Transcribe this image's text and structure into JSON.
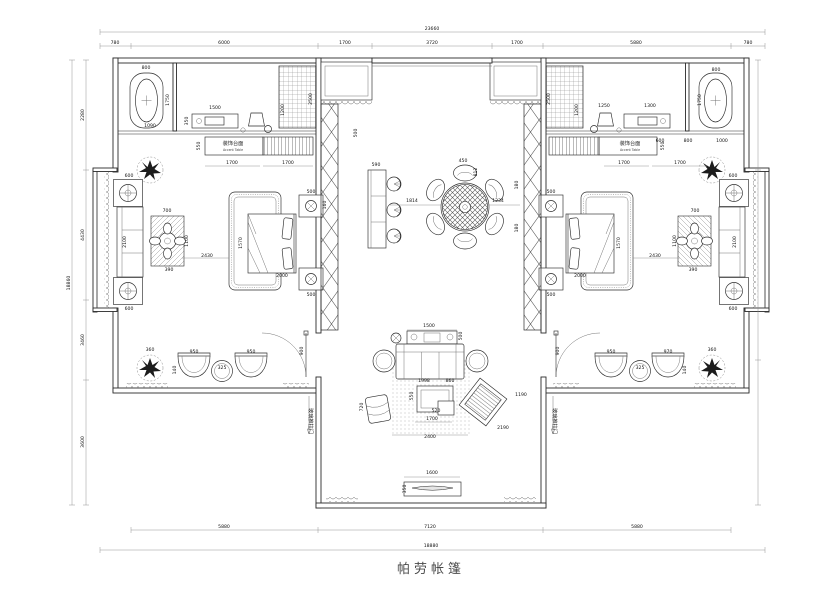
{
  "meta": {
    "drawing_type": "residential floor plan (CAD)",
    "bg_color": "#ffffff",
    "line_color": "#2b2b2b"
  },
  "title": "帕劳帐篷",
  "labels": {
    "accent_table_cn": "装饰台面",
    "accent_table_en": "Accent Table",
    "sliding_door": "玻璃推拉门"
  },
  "dimensions": {
    "top": {
      "overall": "23660",
      "segments": [
        "780",
        "6000",
        "1700",
        "3720",
        "1700",
        "5880",
        "780"
      ]
    },
    "bottom": {
      "overall": "18880",
      "segments": [
        "5880",
        "7120",
        "5880"
      ]
    },
    "left": {
      "overall": "18860",
      "segments": [
        "2280",
        "4430",
        "3460",
        "3600"
      ]
    }
  },
  "annotations": [
    {
      "t": "23660",
      "x": 432,
      "y": 30
    },
    {
      "t": "780",
      "x": 115,
      "y": 44
    },
    {
      "t": "6000",
      "x": 224,
      "y": 44
    },
    {
      "t": "1700",
      "x": 345,
      "y": 44
    },
    {
      "t": "3720",
      "x": 432,
      "y": 44
    },
    {
      "t": "1700",
      "x": 517,
      "y": 44
    },
    {
      "t": "5880",
      "x": 636,
      "y": 44
    },
    {
      "t": "780",
      "x": 748,
      "y": 44
    },
    {
      "t": "5880",
      "x": 224,
      "y": 528
    },
    {
      "t": "7120",
      "x": 430,
      "y": 528
    },
    {
      "t": "5880",
      "x": 637,
      "y": 528
    },
    {
      "t": "18880",
      "x": 431,
      "y": 547
    },
    {
      "t": "18860",
      "x": 70,
      "y": 283,
      "r": -90
    },
    {
      "t": "2280",
      "x": 84,
      "y": 115,
      "r": -90
    },
    {
      "t": "4430",
      "x": 84,
      "y": 235,
      "r": -90
    },
    {
      "t": "3460",
      "x": 84,
      "y": 340,
      "r": -90
    },
    {
      "t": "3600",
      "x": 84,
      "y": 442,
      "r": -90
    },
    {
      "t": "800",
      "x": 146,
      "y": 69
    },
    {
      "t": "1750",
      "x": 169,
      "y": 100,
      "r": -90
    },
    {
      "t": "1090",
      "x": 150,
      "y": 127
    },
    {
      "t": "1500",
      "x": 215,
      "y": 109
    },
    {
      "t": "350",
      "x": 188,
      "y": 121,
      "r": -90
    },
    {
      "t": "2500",
      "x": 312,
      "y": 99,
      "r": -90
    },
    {
      "t": "1200",
      "x": 284,
      "y": 110,
      "r": -90
    },
    {
      "t": "550",
      "x": 200,
      "y": 146,
      "r": -90
    },
    {
      "t": "1700",
      "x": 232,
      "y": 164
    },
    {
      "t": "1700",
      "x": 288,
      "y": 164
    },
    {
      "t": "装饰台面",
      "x": 233,
      "y": 145,
      "c": "cn"
    },
    {
      "t": "Accent Table",
      "x": 233,
      "y": 151,
      "c": "en"
    },
    {
      "t": "500",
      "x": 357,
      "y": 133,
      "r": -90
    },
    {
      "t": "590",
      "x": 376,
      "y": 166
    },
    {
      "t": "160",
      "x": 326,
      "y": 205,
      "r": -90
    },
    {
      "t": "1814",
      "x": 412,
      "y": 202
    },
    {
      "t": "450",
      "x": 463,
      "y": 162
    },
    {
      "t": "812",
      "x": 477,
      "y": 172,
      "r": -90
    },
    {
      "t": "1234",
      "x": 498,
      "y": 202
    },
    {
      "t": "180",
      "x": 518,
      "y": 185,
      "r": -90
    },
    {
      "t": "180",
      "x": 518,
      "y": 228,
      "r": -90
    },
    {
      "t": "700",
      "x": 167,
      "y": 212
    },
    {
      "t": "1100",
      "x": 188,
      "y": 241,
      "r": -90
    },
    {
      "t": "390",
      "x": 169,
      "y": 271
    },
    {
      "t": "2430",
      "x": 207,
      "y": 257
    },
    {
      "t": "1570",
      "x": 242,
      "y": 243,
      "r": -90
    },
    {
      "t": "2000",
      "x": 282,
      "y": 277
    },
    {
      "t": "500",
      "x": 311,
      "y": 193
    },
    {
      "t": "500",
      "x": 311,
      "y": 296
    },
    {
      "t": "600",
      "x": 129,
      "y": 177
    },
    {
      "t": "2100",
      "x": 126,
      "y": 242,
      "r": -90
    },
    {
      "t": "600",
      "x": 129,
      "y": 310
    },
    {
      "t": "360",
      "x": 150,
      "y": 351
    },
    {
      "t": "950",
      "x": 194,
      "y": 353
    },
    {
      "t": "325",
      "x": 222,
      "y": 369
    },
    {
      "t": "950",
      "x": 251,
      "y": 353
    },
    {
      "t": "140",
      "x": 176,
      "y": 370,
      "r": -90
    },
    {
      "t": "900",
      "x": 303,
      "y": 351,
      "r": -90
    },
    {
      "t": "玻璃推拉门",
      "x": 309,
      "y": 421,
      "r": 90,
      "c": "cn"
    },
    {
      "t": "1500",
      "x": 429,
      "y": 327
    },
    {
      "t": "500",
      "x": 462,
      "y": 336,
      "r": -90
    },
    {
      "t": "1998",
      "x": 424,
      "y": 382
    },
    {
      "t": "860",
      "x": 450,
      "y": 382
    },
    {
      "t": "550",
      "x": 413,
      "y": 396,
      "r": -90
    },
    {
      "t": "720",
      "x": 363,
      "y": 407,
      "r": -90
    },
    {
      "t": "520",
      "x": 436,
      "y": 412
    },
    {
      "t": "1700",
      "x": 432,
      "y": 420
    },
    {
      "t": "2400",
      "x": 430,
      "y": 438
    },
    {
      "t": "2190",
      "x": 503,
      "y": 429
    },
    {
      "t": "1190",
      "x": 521,
      "y": 396
    },
    {
      "t": "1600",
      "x": 432,
      "y": 474
    },
    {
      "t": "350",
      "x": 406,
      "y": 489,
      "r": -90
    },
    {
      "t": "2500",
      "x": 550,
      "y": 99,
      "r": -90
    },
    {
      "t": "1200",
      "x": 578,
      "y": 110,
      "r": -90
    },
    {
      "t": "1250",
      "x": 604,
      "y": 107
    },
    {
      "t": "1300",
      "x": 650,
      "y": 107
    },
    {
      "t": "800",
      "x": 716,
      "y": 71
    },
    {
      "t": "1750",
      "x": 701,
      "y": 100,
      "r": -90
    },
    {
      "t": "600",
      "x": 660,
      "y": 142
    },
    {
      "t": "800",
      "x": 688,
      "y": 142
    },
    {
      "t": "1000",
      "x": 722,
      "y": 142
    },
    {
      "t": "550",
      "x": 664,
      "y": 146,
      "r": -90
    },
    {
      "t": "1700",
      "x": 624,
      "y": 164
    },
    {
      "t": "1700",
      "x": 680,
      "y": 164
    },
    {
      "t": "装饰台面",
      "x": 630,
      "y": 145,
      "c": "cn"
    },
    {
      "t": "Accent Table",
      "x": 630,
      "y": 151,
      "c": "en"
    },
    {
      "t": "700",
      "x": 695,
      "y": 212
    },
    {
      "t": "1100",
      "x": 676,
      "y": 241,
      "r": -90
    },
    {
      "t": "390",
      "x": 693,
      "y": 271
    },
    {
      "t": "2430",
      "x": 655,
      "y": 257
    },
    {
      "t": "1570",
      "x": 620,
      "y": 243,
      "r": -90
    },
    {
      "t": "2000",
      "x": 580,
      "y": 277
    },
    {
      "t": "500",
      "x": 551,
      "y": 193
    },
    {
      "t": "500",
      "x": 551,
      "y": 296
    },
    {
      "t": "600",
      "x": 733,
      "y": 177
    },
    {
      "t": "2100",
      "x": 736,
      "y": 242,
      "r": -90
    },
    {
      "t": "600",
      "x": 733,
      "y": 310
    },
    {
      "t": "360",
      "x": 712,
      "y": 351
    },
    {
      "t": "950",
      "x": 611,
      "y": 353
    },
    {
      "t": "325",
      "x": 640,
      "y": 369
    },
    {
      "t": "970",
      "x": 668,
      "y": 353
    },
    {
      "t": "140",
      "x": 686,
      "y": 370,
      "r": -90
    },
    {
      "t": "900",
      "x": 559,
      "y": 351,
      "r": -90
    },
    {
      "t": "玻璃推拉门",
      "x": 553,
      "y": 421,
      "r": 90,
      "c": "cn"
    }
  ]
}
